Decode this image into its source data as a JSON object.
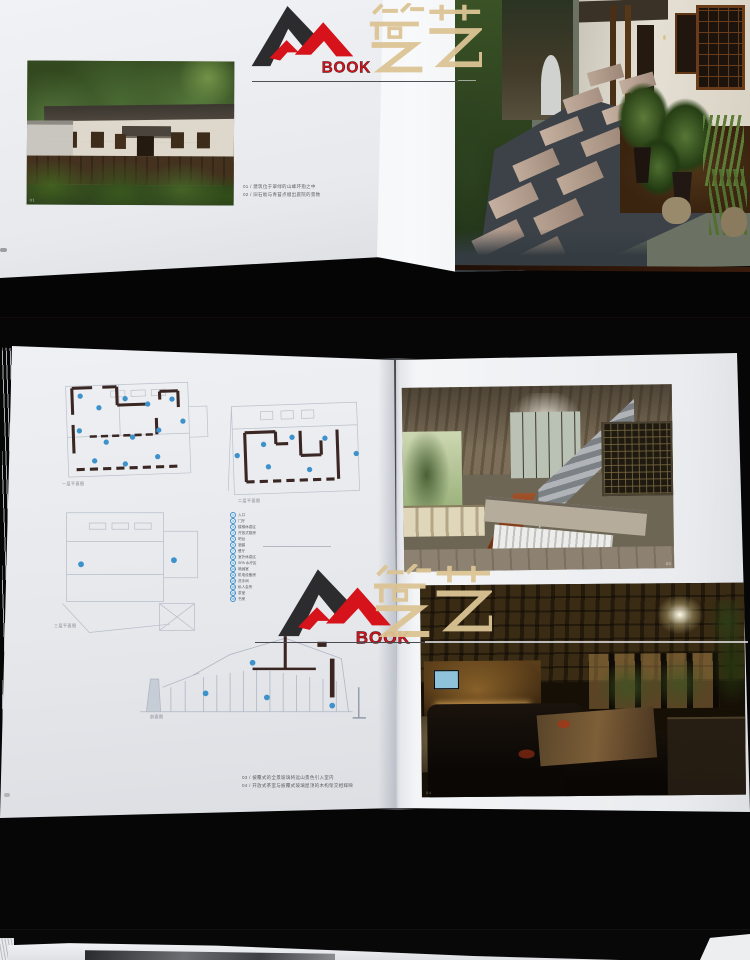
{
  "meta": {
    "description": "Two stacked photographs of an open architecture/interior book on a black table, with a bookstore watermark logo, plus the edge of a third photo at the bottom"
  },
  "watermark": {
    "book_text": "BOOK",
    "cn_text": "筑艺",
    "red": "#d6121b",
    "black": "#2c2c2e",
    "beige": "#dcc494"
  },
  "top_spread": {
    "house_photo_number": "01",
    "captions": [
      "01 / 建筑位于翠绿的山峰环抱之中",
      "02 / 旧石板与青苔点缀出庭院的景致"
    ]
  },
  "middle_spread": {
    "plan_labels": {
      "plan1": "一层平面图",
      "plan2": "二层平面图",
      "plan3": "三层平面图",
      "section": "剖面图"
    },
    "legend": [
      "入口",
      "门厅",
      "楼梯休息区",
      "开放式厨房",
      "吧台",
      "酒窖",
      "餐厅",
      "室外休息区",
      "SPA 水疗区",
      "瑜伽室",
      "机电设备房",
      "洗手间",
      "私人会所",
      "茶室",
      "书房"
    ],
    "captions": [
      "03 / 披覆式的全景玻璃将远山景色引入室内",
      "04 / 开放式茶室与披覆式玻璃屋顶的木构架交相辉映"
    ],
    "photo_numbers": [
      "03",
      "04"
    ]
  },
  "colors": {
    "background": "#050505",
    "page_white": "#e9ebee",
    "plan_dot_blue": "#3d92cb",
    "plan_wall": "#3a2622"
  }
}
